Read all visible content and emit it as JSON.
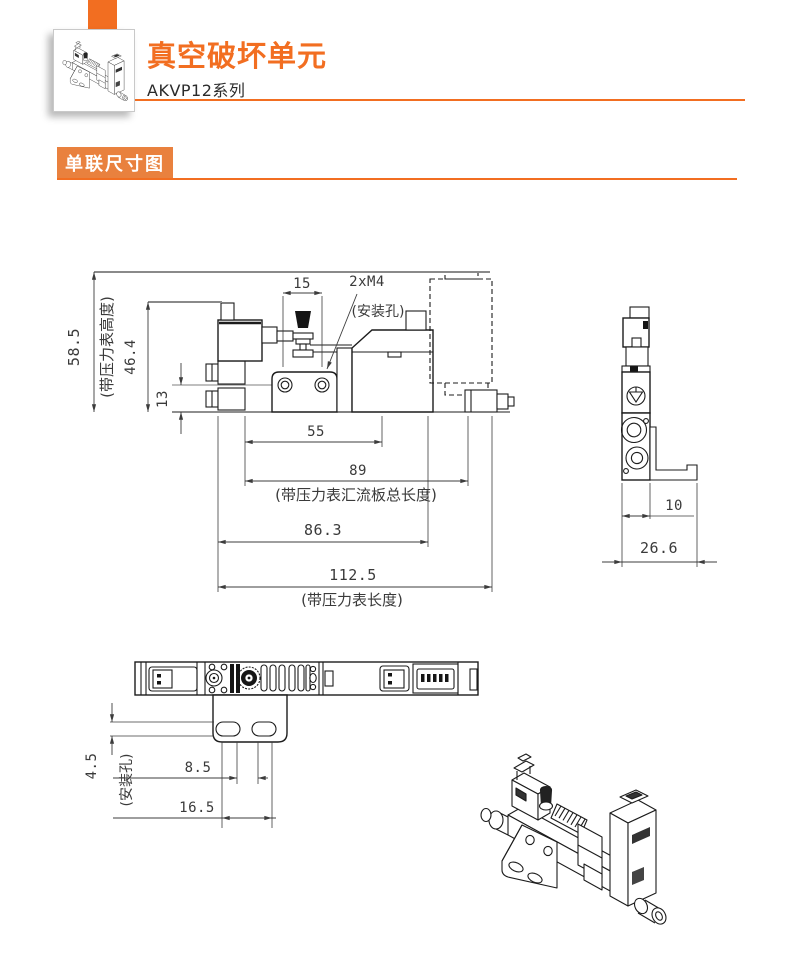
{
  "colors": {
    "accent": "#F26E21",
    "section_badge_bg": "#E9813E",
    "drawing_line": "#1C1C1C",
    "dimension_text": "#3A3A3A",
    "extension_gray": "#8A8A8A"
  },
  "header": {
    "title": "真空破坏单元",
    "series": "AKVP12系列",
    "product_icon": "isometric-product-drawing"
  },
  "section": {
    "label": "单联尺寸图"
  },
  "front_view": {
    "dims": {
      "d15": "15",
      "d2xm4": "2xM4",
      "mount_note": "(安装孔)",
      "d585": "58.5",
      "d585_note": "(带压力表高度)",
      "d464": "46.4",
      "d13": "13",
      "d55": "55",
      "d89": "89",
      "d89_note": "(带压力表汇流板总长度)",
      "d863": "86.3",
      "d1125": "112.5",
      "d1125_note": "(带压力表长度)"
    }
  },
  "side_view": {
    "dims": {
      "d10": "10",
      "d266": "26.6"
    }
  },
  "top_view": {
    "dims": {
      "d45": "4.5",
      "d45_note": "(安装孔)",
      "d85": "8.5",
      "d165": "16.5"
    }
  }
}
